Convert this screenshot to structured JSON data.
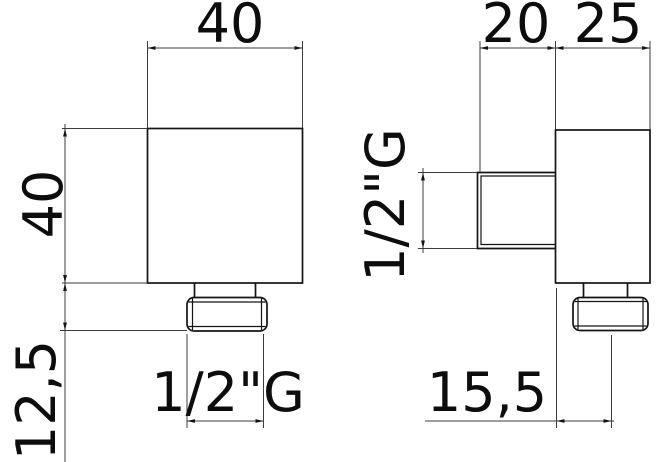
{
  "colors": {
    "background": "#ffffff",
    "object_line": "#141414",
    "dimension_line": "#3c3c3c",
    "text": "#0d0d0d"
  },
  "front_view": {
    "dim_width": "40",
    "dim_height": "40",
    "dim_outlet_length": "12,5",
    "dim_thread": "1/2\"G"
  },
  "side_view": {
    "dim_port_depth": "20",
    "dim_body_depth": "25",
    "dim_thread": "1/2\"G",
    "dim_outlet_offset": "15,5"
  }
}
